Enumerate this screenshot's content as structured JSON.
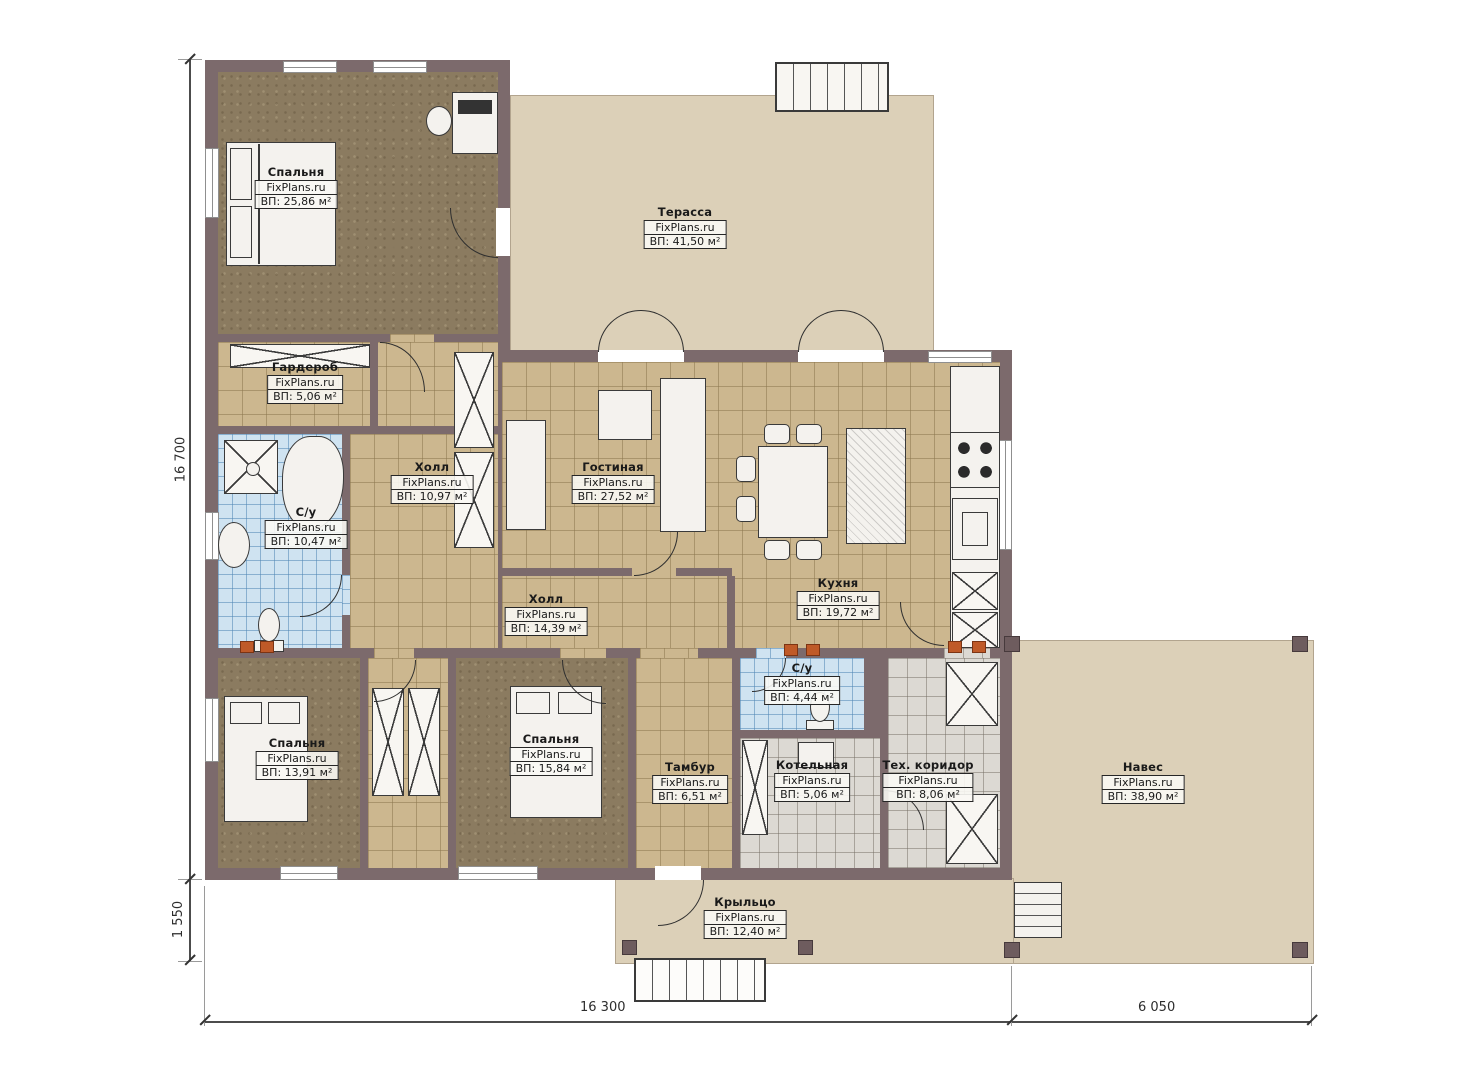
{
  "plan": {
    "watermark": "FixPlans.ru",
    "rooms": [
      {
        "name": "Спальня",
        "area": "ВП: 25,86 м²"
      },
      {
        "name": "Терасса",
        "area": "ВП: 41,50 м²"
      },
      {
        "name": "Гардероб",
        "area": "ВП: 5,06 м²"
      },
      {
        "name": "Холл",
        "area": "ВП: 10,97 м²"
      },
      {
        "name": "Гостиная",
        "area": "ВП: 27,52 м²"
      },
      {
        "name": "С/у",
        "area": "ВП: 10,47 м²"
      },
      {
        "name": "Холл",
        "area": "ВП: 14,39 м²"
      },
      {
        "name": "Кухня",
        "area": "ВП: 19,72 м²"
      },
      {
        "name": "С/у",
        "area": "ВП: 4,44 м²"
      },
      {
        "name": "Спальня",
        "area": "ВП: 13,91 м²"
      },
      {
        "name": "Спальня",
        "area": "ВП: 15,84 м²"
      },
      {
        "name": "Тамбур",
        "area": "ВП: 6,51 м²"
      },
      {
        "name": "Котельная",
        "area": "ВП: 5,06 м²"
      },
      {
        "name": "Тех. коридор",
        "area": "ВП: 8,06 м²"
      },
      {
        "name": "Навес",
        "area": "ВП: 38,90 м²"
      },
      {
        "name": "Крыльцо",
        "area": "ВП: 12,40 м²"
      }
    ],
    "dimensions": {
      "left_height": "16 700",
      "left_porch": "1 550",
      "bottom_main": "16 300",
      "bottom_canopy": "6 050"
    },
    "colors": {
      "wall": "#7c6a6c",
      "floor_wood": "#8b7b60",
      "floor_tile_tan": "#ccb78f",
      "floor_tile_blue": "#cfe3f1",
      "floor_tile_gray": "#dcd9d3",
      "outdoor": "#dcd0b8",
      "marker_orange": "#bf5a28"
    }
  }
}
